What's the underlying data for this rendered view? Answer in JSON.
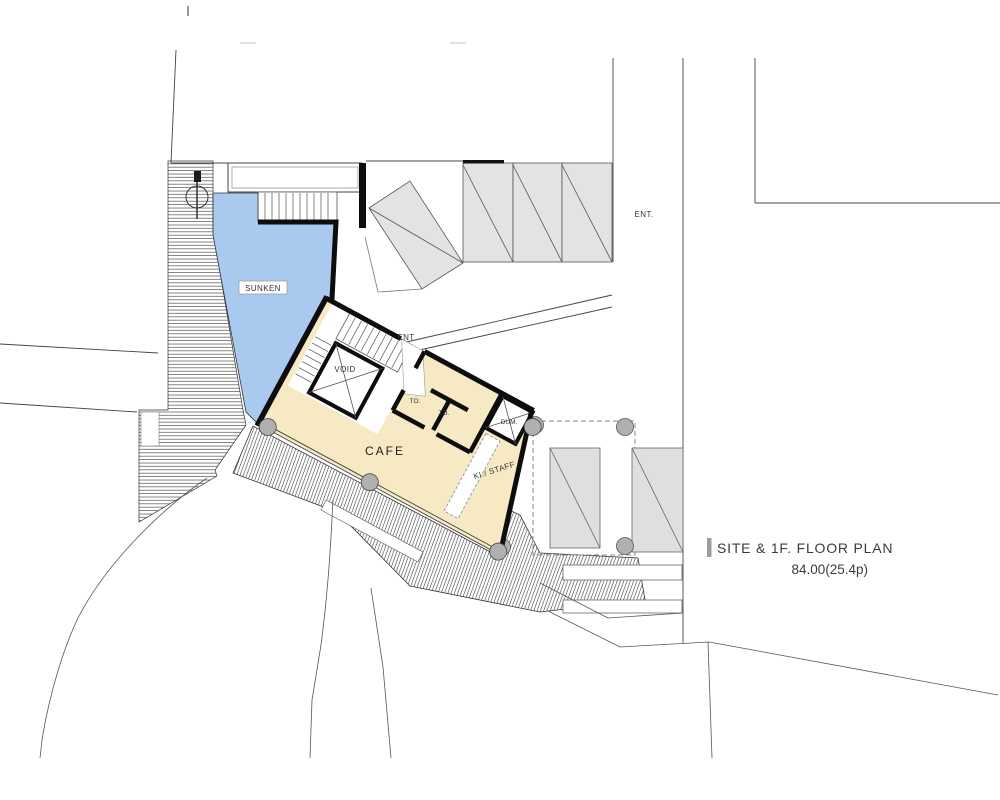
{
  "title_block": {
    "title": "SITE & 1F. FLOOR PLAN",
    "area": "84.00(25.4p)"
  },
  "labels": {
    "sunken": "SUNKEN",
    "entrance_building": "ENT",
    "entrance_road": "ENT.",
    "void_shaft": "VOID",
    "toilet_1": "TO.",
    "toilet_2": "TO.",
    "dumbwaiter": "DUM.",
    "cafe": "CAFE",
    "kitchen_staff": "KI./ STAFF"
  },
  "colors": {
    "sunken_fill": "#a9caee",
    "cafe_floor_fill": "#f6e9c4",
    "roof_fill": "#e3e3e3",
    "canopy_fill": "#dfdfdf",
    "column_fill": "#b0b0b0",
    "title_bar": "#9c9c9c"
  }
}
